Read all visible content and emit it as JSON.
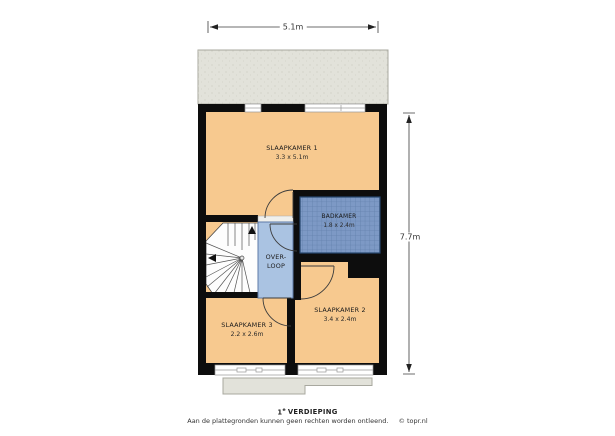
{
  "title": {
    "floor_number": "1",
    "floor_sup": "e",
    "floor_word": "VERDIEPING"
  },
  "footer": {
    "disclaimer": "Aan de plattegronden kunnen geen rechten worden ontleend.",
    "credit": "© topr.nl"
  },
  "dimensions": {
    "width": "5.1m",
    "height": "7.7m"
  },
  "rooms": {
    "slaapkamer1": {
      "name": "SLAAPKAMER 1",
      "size": "3.3 x 5.1m"
    },
    "badkamer": {
      "name": "BADKAMER",
      "size": "1.8 x 2.4m"
    },
    "overloop": {
      "line1": "OVER-",
      "line2": "LOOP"
    },
    "slaapkamer2": {
      "name": "SLAAPKAMER 2",
      "size": "3.4 x 2.4m"
    },
    "slaapkamer3": {
      "name": "SLAAPKAMER 3",
      "size": "2.2 x 2.6m"
    }
  },
  "colors": {
    "wall": "#0d0d0d",
    "floor": "#f7c98f",
    "landing": "#aac3e2",
    "landing-border": "#5d7aa8",
    "tile": "#7d99c5",
    "tile-line": "#6381ad",
    "tile-border": "#26466e",
    "roof": "#e2e2da",
    "roof-border": "#a8a89f",
    "line": "#3c3c3c",
    "window": "#ffffff",
    "window-line": "#989898"
  }
}
